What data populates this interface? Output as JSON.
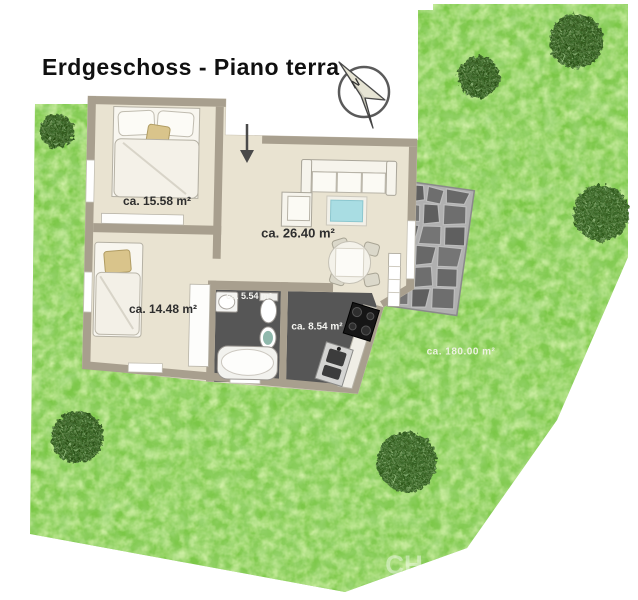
{
  "title": "Erdgeschoss - Piano terra",
  "compass": {
    "label": "N"
  },
  "rooms": [
    {
      "name": "bedroom-1",
      "area_label": "ca. 15.58 m²"
    },
    {
      "name": "living-room",
      "area_label": "ca. 26.40 m²"
    },
    {
      "name": "bedroom-2",
      "area_label": "ca. 14.48 m²"
    },
    {
      "name": "bathroom",
      "area_label": "ca. 5.54 m²"
    },
    {
      "name": "kitchen",
      "area_label": "ca. 8.54 m²"
    }
  ],
  "garden": {
    "area_label": "ca. 180.00 m²"
  },
  "watermark": "CH",
  "colors": {
    "lawn": "#7cc848",
    "tree": "#274a12",
    "wall": "#a89f8e",
    "floor": "#e9e3d1",
    "wet_room_floor": "#565656",
    "patio_stone": "#646464",
    "coffee_table": "#a9dde3",
    "accent_cushion": "#d9c48b"
  }
}
